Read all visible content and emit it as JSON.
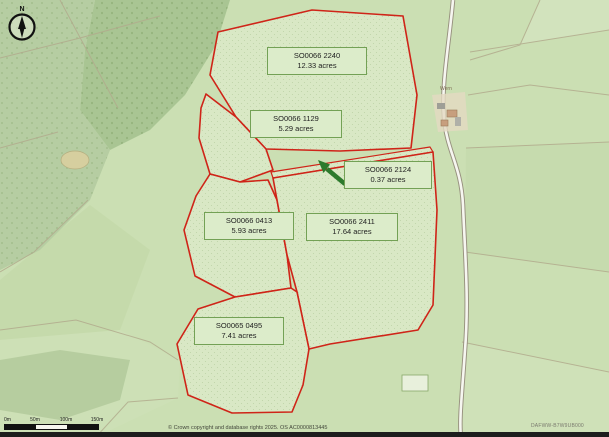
{
  "map": {
    "title_hint": "field parcel map",
    "parcels": [
      {
        "id": "SO0066 2240",
        "area": "12.33 acres"
      },
      {
        "id": "SO0066 1129",
        "area": "5.29 acres"
      },
      {
        "id": "SO0066 2124",
        "area": "0.37 acres"
      },
      {
        "id": "SO0066 0413",
        "area": "5.93 acres"
      },
      {
        "id": "SO0066 2411",
        "area": "17.64 acres"
      },
      {
        "id": "SO0065 0495",
        "area": "7.41 acres"
      }
    ],
    "place_label": "Wern",
    "compass_label": "N"
  },
  "scalebar": {
    "labels": [
      "0m",
      "50m",
      "100m",
      "150m"
    ]
  },
  "footer": {
    "copyright": "© Crown copyright and database rights 2025. OS AC0000813445",
    "reference": "DAFWW-B7W9UB000"
  },
  "colors": {
    "parcel_outline": "#cf2418",
    "label_border": "#73a155",
    "label_fill": "#dcecca",
    "arrow": "#2c7a2c",
    "field_base": "#cbdfb3",
    "woodland": "#a9c593"
  }
}
